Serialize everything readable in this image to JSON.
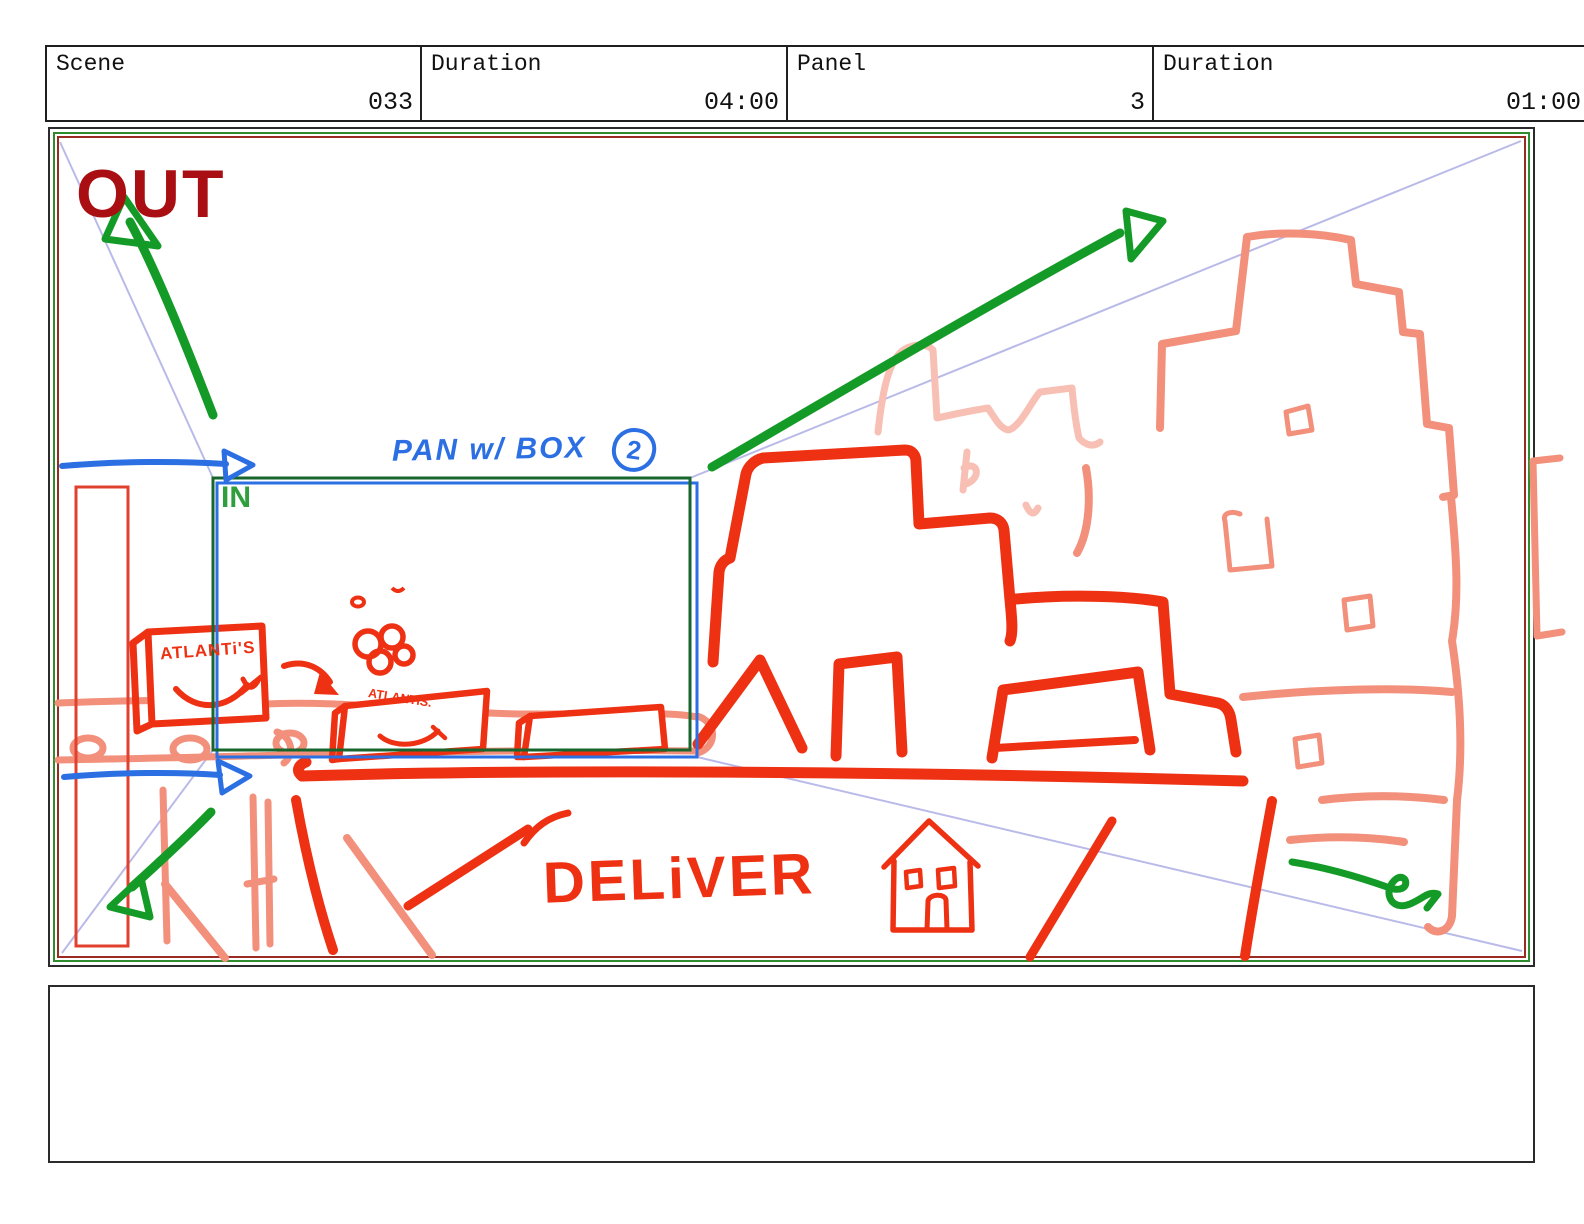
{
  "header": {
    "cells": [
      {
        "label": "Scene",
        "value": "033"
      },
      {
        "label": "Duration",
        "value": "04:00"
      },
      {
        "label": "Panel",
        "value": "3"
      },
      {
        "label": "Duration",
        "value": "01:00"
      }
    ]
  },
  "panel": {
    "out_label": "OUT",
    "in_label": "IN",
    "pan_note": "PAN w/ BOX",
    "pan_note_number": "2",
    "box1_label": "ATLANTi'S",
    "box2_label": "ATLANTiS.",
    "deliver_label": "DELiVER"
  },
  "colors": {
    "sketch_red": "#ee3113",
    "sketch_salmon": "#f2907c",
    "sketch_pink": "#f8bfb4",
    "arrow_green": "#149b27",
    "note_blue": "#2b6fe3",
    "out_dark_red": "#a90f12",
    "guide_lavender": "#b9bae8",
    "frame_green": "#2e8b2e",
    "frame_maroon": "#9a2b22",
    "in_frame_green": "#17662e"
  },
  "notes": {
    "text": ""
  }
}
